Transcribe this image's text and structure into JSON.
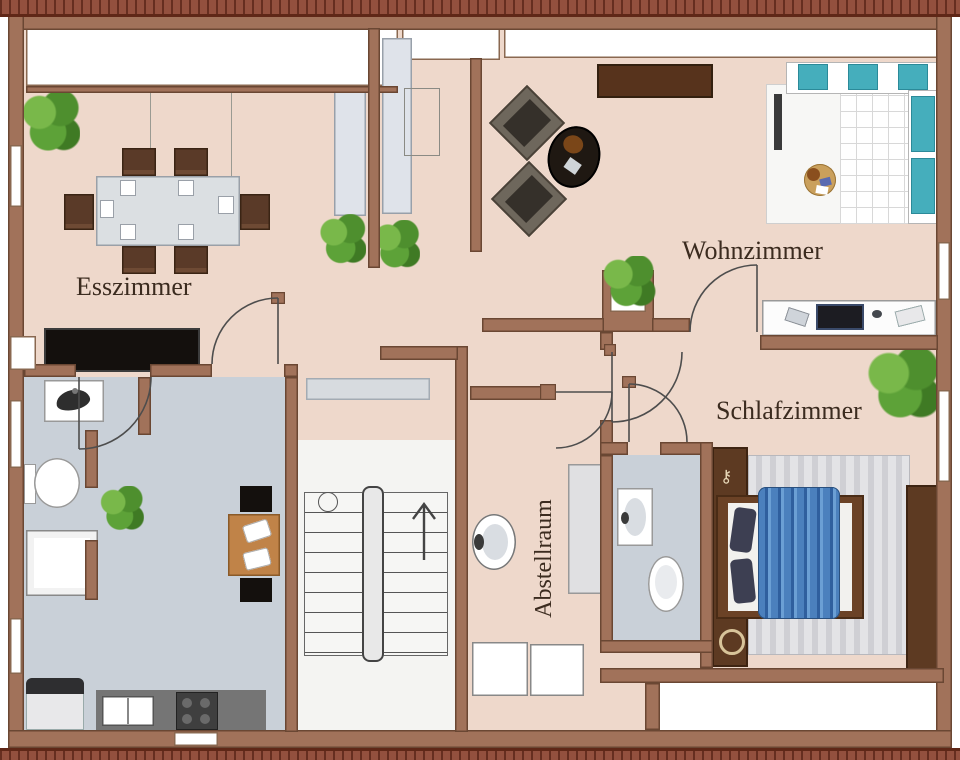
{
  "title": "Wohnung Grundriss (floor plan)",
  "rooms": {
    "esszimmer": {
      "label": "Esszimmer"
    },
    "wohnzimmer": {
      "label": "Wohnzimmer"
    },
    "schlafzimmer": {
      "label": "Schlafzimmer"
    },
    "abstellraum": {
      "label": "Abstellraum"
    }
  },
  "colors": {
    "wall": "#a1725a",
    "wall_outline": "#6a4733",
    "floor_main": "#eed8cb",
    "floor_wet": "#c9d0d8",
    "floor_stair": "#f4f4f2",
    "roof": "#93503e",
    "bed_blanket": "#4b80bd",
    "sofa_cushion": "#45aebc",
    "plant_green": "#55942f",
    "wood": "#c08348",
    "counter_gray": "#757575",
    "dark_furniture": "#14100d",
    "label_color": "#3b2b1f"
  },
  "furniture_icons": [
    "dining-table",
    "dining-chair",
    "rug",
    "sideboard",
    "wardrobe",
    "armchair",
    "coffee-table",
    "sofa",
    "sofa-cushion",
    "round-table",
    "desk",
    "computer",
    "plant",
    "bed",
    "pillow",
    "blanket",
    "bedside-rug",
    "stairs",
    "stair-railing",
    "up-arrow",
    "washbasin",
    "toilet",
    "shower",
    "sink",
    "kitchen-counter",
    "kitchen-sink",
    "stove",
    "fridge",
    "kitchen-table",
    "cabinet",
    "shelf",
    "window",
    "door"
  ]
}
